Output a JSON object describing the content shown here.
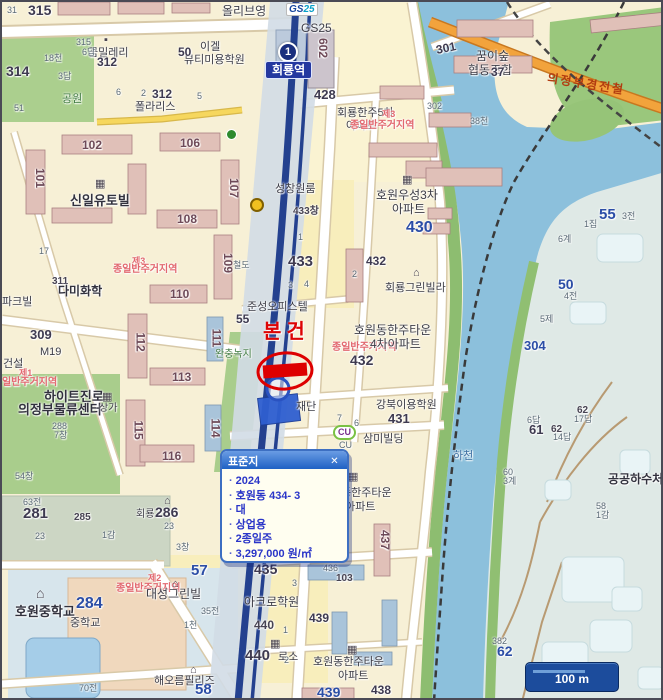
{
  "popup": {
    "title": "표준지",
    "close": "✕",
    "items": [
      "2024",
      "호원동 434- 3",
      "대",
      "상업용",
      "2종일주",
      "3,297,000 원/㎡"
    ]
  },
  "station": {
    "line_badge": "1",
    "name": "회룡역"
  },
  "logos": {
    "gs25_1": "GS",
    "gs25_2": "25",
    "cu": "CU"
  },
  "scale_bar": {
    "label": "100 m"
  },
  "map_labels": [
    {
      "t": "315",
      "x": 26,
      "y": 1,
      "c": "num",
      "s": 14
    },
    {
      "t": "31",
      "x": 5,
      "y": 4,
      "c": "sm"
    },
    {
      "t": "올리브영",
      "x": 220,
      "y": 3,
      "c": "n",
      "s": 12
    },
    {
      "t": "GS25",
      "x": 299,
      "y": 20,
      "c": "n",
      "s": 12
    },
    {
      "t": "이겔",
      "x": 198,
      "y": 40,
      "c": "n"
    },
    {
      "t": "뷰티미용학원",
      "x": 182,
      "y": 53,
      "c": "n"
    },
    {
      "t": "50",
      "x": 176,
      "y": 44,
      "c": "num",
      "s": 12
    },
    {
      "t": "꿈밀레리",
      "x": 86,
      "y": 46,
      "c": "n"
    },
    {
      "t": "315",
      "x": 74,
      "y": 36,
      "c": "sm"
    },
    {
      "t": "6답",
      "x": 80,
      "y": 46,
      "c": "sm"
    },
    {
      "t": "18천",
      "x": 42,
      "y": 52,
      "c": "sm"
    },
    {
      "t": "314",
      "x": 4,
      "y": 62,
      "c": "num",
      "s": 14
    },
    {
      "t": "3답",
      "x": 56,
      "y": 70,
      "c": "sm"
    },
    {
      "t": "312",
      "x": 95,
      "y": 54,
      "c": "num",
      "s": 12
    },
    {
      "t": "공원",
      "x": 60,
      "y": 92,
      "c": "grn"
    },
    {
      "t": "51",
      "x": 12,
      "y": 102,
      "c": "sm"
    },
    {
      "t": "6",
      "x": 114,
      "y": 86,
      "c": "sm"
    },
    {
      "t": "2",
      "x": 139,
      "y": 87,
      "c": "sm"
    },
    {
      "t": "312",
      "x": 150,
      "y": 86,
      "c": "num",
      "s": 12
    },
    {
      "t": "5",
      "x": 195,
      "y": 90,
      "c": "sm"
    },
    {
      "t": "폴라리스",
      "x": 133,
      "y": 100,
      "c": "n"
    },
    {
      "t": "602",
      "x": 311,
      "y": 40,
      "c": "bnum",
      "r": 90
    },
    {
      "t": "428",
      "x": 312,
      "y": 86,
      "c": "num"
    },
    {
      "t": "회룡한주5차",
      "x": 335,
      "y": 106,
      "c": "n"
    },
    {
      "t": "아파트",
      "x": 344,
      "y": 119,
      "c": "n"
    },
    {
      "t": "꿈이숲",
      "x": 474,
      "y": 48,
      "c": "n",
      "s": 12
    },
    {
      "t": "협동조합",
      "x": 466,
      "y": 62,
      "c": "n",
      "s": 12
    },
    {
      "t": "제3",
      "x": 380,
      "y": 108,
      "c": "red",
      "s": 9
    },
    {
      "t": "종일반주거지역",
      "x": 348,
      "y": 119,
      "c": "red"
    },
    {
      "t": "38천",
      "x": 468,
      "y": 115,
      "c": "sm"
    },
    {
      "t": "301",
      "x": 434,
      "y": 40,
      "c": "num",
      "s": 12,
      "r": -12
    },
    {
      "t": "37",
      "x": 489,
      "y": 64,
      "c": "num",
      "s": 12
    },
    {
      "t": "302",
      "x": 425,
      "y": 100,
      "c": "sm"
    },
    {
      "t": "의정부경전철",
      "x": 545,
      "y": 76,
      "c": "hwy",
      "r": 9
    },
    {
      "t": "호원우성3차",
      "x": 374,
      "y": 187,
      "c": "n",
      "s": 12
    },
    {
      "t": "아파트",
      "x": 390,
      "y": 201,
      "c": "n",
      "s": 12
    },
    {
      "t": "430",
      "x": 404,
      "y": 218,
      "c": "numb",
      "s": 16
    },
    {
      "t": "성창원룸",
      "x": 273,
      "y": 182,
      "c": "n"
    },
    {
      "t": "433창",
      "x": 291,
      "y": 205,
      "c": "smd"
    },
    {
      "t": "433",
      "x": 286,
      "y": 252,
      "c": "num",
      "s": 15
    },
    {
      "t": "432",
      "x": 364,
      "y": 253,
      "c": "num",
      "s": 12
    },
    {
      "t": "회룡그린빌라",
      "x": 383,
      "y": 281,
      "c": "n"
    },
    {
      "t": "철도",
      "x": 231,
      "y": 259,
      "c": "sm"
    },
    {
      "t": "준성오피스텔",
      "x": 245,
      "y": 300,
      "c": "n"
    },
    {
      "t": "55",
      "x": 234,
      "y": 311,
      "c": "num",
      "s": 12
    },
    {
      "t": "본건",
      "x": 261,
      "y": 320,
      "c": "redbig"
    },
    {
      "t": "완충녹지",
      "x": 213,
      "y": 348,
      "c": "grn",
      "s": 10
    },
    {
      "t": "호원동한주타운",
      "x": 352,
      "y": 322,
      "c": "n",
      "s": 12
    },
    {
      "t": "종일반주거지역",
      "x": 330,
      "y": 341,
      "c": "red"
    },
    {
      "t": "4차아파트",
      "x": 368,
      "y": 336,
      "c": "n",
      "s": 12
    },
    {
      "t": "432",
      "x": 348,
      "y": 351,
      "c": "num",
      "s": 14
    },
    {
      "t": "강북이용학원",
      "x": 374,
      "y": 398,
      "c": "n"
    },
    {
      "t": "431",
      "x": 386,
      "y": 410,
      "c": "num"
    },
    {
      "t": "재단",
      "x": 294,
      "y": 400,
      "c": "n"
    },
    {
      "t": "CU",
      "x": 337,
      "y": 439,
      "c": "sm"
    },
    {
      "t": "삼미빌딩",
      "x": 361,
      "y": 432,
      "c": "n"
    },
    {
      "t": "하천",
      "x": 451,
      "y": 449,
      "c": "blu"
    },
    {
      "t": "동한주타운",
      "x": 339,
      "y": 486,
      "c": "n"
    },
    {
      "t": "차아파트",
      "x": 333,
      "y": 500,
      "c": "n"
    },
    {
      "t": "437",
      "x": 373,
      "y": 532,
      "c": "bnum",
      "r": 90
    },
    {
      "t": "436",
      "x": 321,
      "y": 562,
      "c": "sm"
    },
    {
      "t": "103",
      "x": 334,
      "y": 572,
      "c": "smd"
    },
    {
      "t": "435",
      "x": 252,
      "y": 560,
      "c": "num",
      "s": 14
    },
    {
      "t": "57",
      "x": 189,
      "y": 561,
      "c": "numb",
      "s": 15
    },
    {
      "t": "아크로학원",
      "x": 242,
      "y": 594,
      "c": "n",
      "s": 12
    },
    {
      "t": "440",
      "x": 252,
      "y": 617,
      "c": "smd",
      "s": 12
    },
    {
      "t": "439",
      "x": 307,
      "y": 610,
      "c": "num",
      "s": 12
    },
    {
      "t": "440",
      "x": 243,
      "y": 646,
      "c": "num",
      "s": 15
    },
    {
      "t": "로소",
      "x": 276,
      "y": 650,
      "c": "n"
    },
    {
      "t": "호원동한주타운",
      "x": 311,
      "y": 655,
      "c": "n"
    },
    {
      "t": "아파트",
      "x": 336,
      "y": 669,
      "c": "n"
    },
    {
      "t": "439",
      "x": 315,
      "y": 683,
      "c": "numb"
    },
    {
      "t": "438",
      "x": 369,
      "y": 682,
      "c": "num",
      "s": 12
    },
    {
      "t": "309",
      "x": 28,
      "y": 326,
      "c": "num"
    },
    {
      "t": "M19",
      "x": 38,
      "y": 345,
      "c": "n"
    },
    {
      "t": "건설",
      "x": 1,
      "y": 357,
      "c": "n"
    },
    {
      "t": "제1",
      "x": 17,
      "y": 367,
      "c": "red",
      "s": 9
    },
    {
      "t": "일반주거지역",
      "x": 0,
      "y": 376,
      "c": "red"
    },
    {
      "t": "하이트진로",
      "x": 42,
      "y": 388,
      "c": "nl"
    },
    {
      "t": "의정부물류센터",
      "x": 16,
      "y": 401,
      "c": "nl"
    },
    {
      "t": "288",
      "x": 50,
      "y": 420,
      "c": "sm"
    },
    {
      "t": "7창",
      "x": 52,
      "y": 429,
      "c": "sm"
    },
    {
      "t": "상가",
      "x": 97,
      "y": 402,
      "c": "n",
      "s": 10
    },
    {
      "t": "54창",
      "x": 13,
      "y": 470,
      "c": "sm"
    },
    {
      "t": "63전",
      "x": 21,
      "y": 496,
      "c": "sm"
    },
    {
      "t": "281",
      "x": 21,
      "y": 504,
      "c": "num",
      "s": 15
    },
    {
      "t": "23",
      "x": 33,
      "y": 530,
      "c": "sm"
    },
    {
      "t": "285",
      "x": 72,
      "y": 511,
      "c": "smd"
    },
    {
      "t": "1감",
      "x": 100,
      "y": 529,
      "c": "sm"
    },
    {
      "t": "회룡",
      "x": 134,
      "y": 508,
      "c": "n",
      "s": 10
    },
    {
      "t": "286",
      "x": 153,
      "y": 503,
      "c": "num",
      "s": 14
    },
    {
      "t": "23",
      "x": 162,
      "y": 520,
      "c": "sm"
    },
    {
      "t": "3창",
      "x": 174,
      "y": 541,
      "c": "sm"
    },
    {
      "t": "파크빌",
      "x": 0,
      "y": 295,
      "c": "n"
    },
    {
      "t": "17",
      "x": 37,
      "y": 245,
      "c": "sm"
    },
    {
      "t": "311",
      "x": 50,
      "y": 275,
      "c": "smd"
    },
    {
      "t": "다미화학",
      "x": 56,
      "y": 283,
      "c": "nl",
      "s": 12
    },
    {
      "t": "제3",
      "x": 130,
      "y": 255,
      "c": "red",
      "s": 9
    },
    {
      "t": "종일반주거지역",
      "x": 111,
      "y": 263,
      "c": "red"
    },
    {
      "t": "신일유토빌",
      "x": 68,
      "y": 192,
      "c": "nl"
    },
    {
      "t": "102",
      "x": 80,
      "y": 137,
      "c": "bnum"
    },
    {
      "t": "106",
      "x": 178,
      "y": 135,
      "c": "bnum"
    },
    {
      "t": "101",
      "x": 28,
      "y": 170,
      "c": "bnum",
      "r": 90
    },
    {
      "t": "107",
      "x": 222,
      "y": 180,
      "c": "bnum",
      "r": 90
    },
    {
      "t": "108",
      "x": 175,
      "y": 211,
      "c": "bnum"
    },
    {
      "t": "109",
      "x": 216,
      "y": 255,
      "c": "bnum",
      "r": 90
    },
    {
      "t": "110",
      "x": 168,
      "y": 286,
      "c": "bnum"
    },
    {
      "t": "111",
      "x": 205,
      "y": 330,
      "c": "bnum",
      "r": 90
    },
    {
      "t": "112",
      "x": 129,
      "y": 334,
      "c": "bnum",
      "r": 90
    },
    {
      "t": "113",
      "x": 170,
      "y": 369,
      "c": "bnum"
    },
    {
      "t": "114",
      "x": 204,
      "y": 420,
      "c": "bnum",
      "r": 90
    },
    {
      "t": "115",
      "x": 127,
      "y": 422,
      "c": "bnum",
      "r": 90
    },
    {
      "t": "116",
      "x": 160,
      "y": 448,
      "c": "bnum"
    },
    {
      "t": "호원중학교",
      "x": 13,
      "y": 603,
      "c": "nl"
    },
    {
      "t": "284",
      "x": 74,
      "y": 594,
      "c": "numb",
      "s": 16
    },
    {
      "t": "중학교",
      "x": 68,
      "y": 616,
      "c": "n"
    },
    {
      "t": "제2",
      "x": 146,
      "y": 572,
      "c": "red",
      "s": 9
    },
    {
      "t": "종일반주거지역",
      "x": 114,
      "y": 582,
      "c": "red"
    },
    {
      "t": "대성그린빌",
      "x": 144,
      "y": 586,
      "c": "n",
      "s": 12
    },
    {
      "t": "35전",
      "x": 199,
      "y": 605,
      "c": "sm"
    },
    {
      "t": "1천",
      "x": 182,
      "y": 619,
      "c": "sm"
    },
    {
      "t": "해오름필리즈",
      "x": 152,
      "y": 674,
      "c": "n"
    },
    {
      "t": "58",
      "x": 193,
      "y": 680,
      "c": "numb",
      "s": 15
    },
    {
      "t": "70전",
      "x": 77,
      "y": 682,
      "c": "sm"
    },
    {
      "t": "55",
      "x": 597,
      "y": 205,
      "c": "numb",
      "s": 15
    },
    {
      "t": "3전",
      "x": 620,
      "y": 210,
      "c": "sm"
    },
    {
      "t": "1집",
      "x": 582,
      "y": 218,
      "c": "sm"
    },
    {
      "t": "6계",
      "x": 556,
      "y": 233,
      "c": "sm"
    },
    {
      "t": "50",
      "x": 556,
      "y": 275,
      "c": "numb"
    },
    {
      "t": "4전",
      "x": 562,
      "y": 290,
      "c": "sm"
    },
    {
      "t": "5제",
      "x": 538,
      "y": 313,
      "c": "sm"
    },
    {
      "t": "304",
      "x": 522,
      "y": 337,
      "c": "numb",
      "s": 13
    },
    {
      "t": "6답",
      "x": 525,
      "y": 414,
      "c": "sm"
    },
    {
      "t": "61",
      "x": 527,
      "y": 421,
      "c": "num"
    },
    {
      "t": "62",
      "x": 549,
      "y": 423,
      "c": "smd"
    },
    {
      "t": "14답",
      "x": 551,
      "y": 431,
      "c": "sm"
    },
    {
      "t": "62",
      "x": 575,
      "y": 404,
      "c": "smd"
    },
    {
      "t": "17답",
      "x": 572,
      "y": 413,
      "c": "sm"
    },
    {
      "t": "60",
      "x": 501,
      "y": 466,
      "c": "sm"
    },
    {
      "t": "3계",
      "x": 501,
      "y": 475,
      "c": "sm"
    },
    {
      "t": "공공하수처리",
      "x": 606,
      "y": 471,
      "c": "nl",
      "s": 12
    },
    {
      "t": "58",
      "x": 594,
      "y": 500,
      "c": "sm"
    },
    {
      "t": "1감",
      "x": 594,
      "y": 509,
      "c": "sm"
    },
    {
      "t": "382",
      "x": 490,
      "y": 635,
      "c": "sm"
    },
    {
      "t": "62",
      "x": 495,
      "y": 642,
      "c": "numb"
    },
    {
      "t": "7",
      "x": 335,
      "y": 412,
      "c": "sm"
    },
    {
      "t": "6",
      "x": 352,
      "y": 417,
      "c": "sm"
    },
    {
      "t": "1",
      "x": 296,
      "y": 231,
      "c": "sm"
    },
    {
      "t": "3",
      "x": 286,
      "y": 279,
      "c": "sm"
    },
    {
      "t": "4",
      "x": 302,
      "y": 278,
      "c": "sm"
    },
    {
      "t": "2",
      "x": 350,
      "y": 268,
      "c": "sm"
    },
    {
      "t": "1",
      "x": 281,
      "y": 624,
      "c": "sm"
    },
    {
      "t": "2",
      "x": 282,
      "y": 654,
      "c": "sm"
    },
    {
      "t": "3",
      "x": 290,
      "y": 577,
      "c": "sm"
    }
  ],
  "map_icons": [
    {
      "k": "apartment-icon",
      "g": "▦",
      "x": 93,
      "y": 177
    },
    {
      "k": "apartment-icon",
      "g": "▦",
      "x": 400,
      "y": 173
    },
    {
      "k": "apartment-icon",
      "g": "▦",
      "x": 346,
      "y": 470
    },
    {
      "k": "apartment-icon",
      "g": "▦",
      "x": 345,
      "y": 643
    },
    {
      "k": "building-icon",
      "g": "▦",
      "x": 268,
      "y": 637
    },
    {
      "k": "building-icon",
      "g": "▦",
      "x": 100,
      "y": 390
    },
    {
      "k": "house-icon",
      "g": "⌂",
      "x": 411,
      "y": 266
    },
    {
      "k": "house-icon",
      "g": "⌂",
      "x": 162,
      "y": 494
    },
    {
      "k": "house-icon",
      "g": "⌂",
      "x": 170,
      "y": 577
    },
    {
      "k": "house-icon",
      "g": "⌂",
      "x": 188,
      "y": 663
    },
    {
      "k": "school-icon",
      "g": "⌂",
      "x": 34,
      "y": 584
    },
    {
      "k": "shop-icon",
      "g": "▪",
      "x": 102,
      "y": 33
    }
  ],
  "subject_marker_label": "본건"
}
